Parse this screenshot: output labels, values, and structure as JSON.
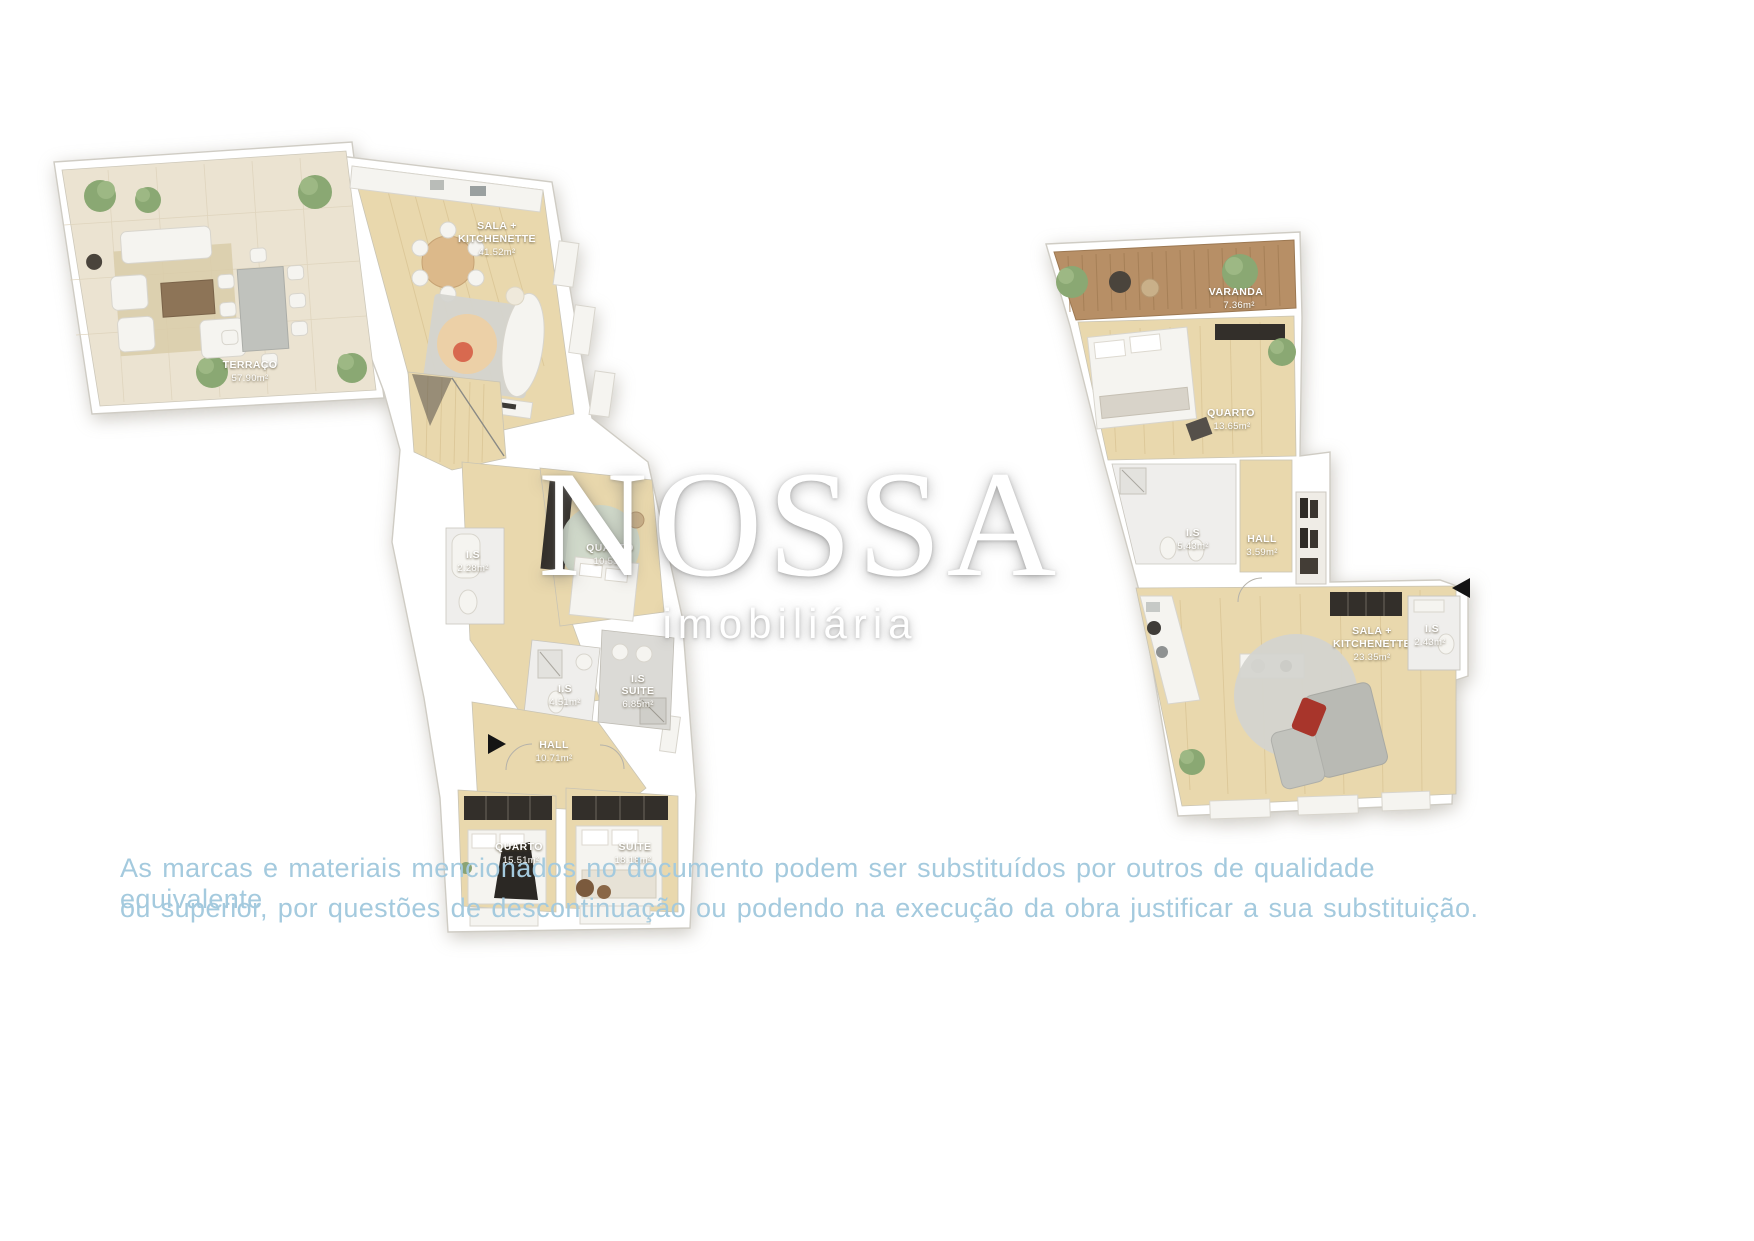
{
  "watermark": {
    "brand": "NOSSA",
    "tagline": "imobiliária"
  },
  "disclaimer": {
    "lines": [
      "As marcas e materiais mencionados no documento podem ser substituídos por outros de qualidade equivalente",
      "ou superior, por questões de descontinuação ou podendo na execução da obra justificar a sua substituição."
    ],
    "text_color": "#a4cade"
  },
  "plans": [
    {
      "name": "floor-plan-left",
      "rooms": [
        {
          "label_lines": [
            "TERRAÇO"
          ],
          "area": "57.90m²"
        },
        {
          "label_lines": [
            "SALA +",
            "KITCHENETTE"
          ],
          "area": "41.52m²"
        },
        {
          "label_lines": [
            "I.S"
          ],
          "area": "2.28m²"
        },
        {
          "label_lines": [
            "QUARTO"
          ],
          "area": "10.51m²"
        },
        {
          "label_lines": [
            "I.S"
          ],
          "area": "4.51m²"
        },
        {
          "label_lines": [
            "I.S",
            "SUITE"
          ],
          "area": "6.85m²"
        },
        {
          "label_lines": [
            "HALL"
          ],
          "area": "10.71m²"
        },
        {
          "label_lines": [
            "QUARTO"
          ],
          "area": "15.51m²"
        },
        {
          "label_lines": [
            "SUITE"
          ],
          "area": "18.18m²"
        }
      ]
    },
    {
      "name": "floor-plan-right",
      "rooms": [
        {
          "label_lines": [
            "VARANDA"
          ],
          "area": "7.36m²"
        },
        {
          "label_lines": [
            "QUARTO"
          ],
          "area": "13.65m²"
        },
        {
          "label_lines": [
            "I.S"
          ],
          "area": "5.43m²"
        },
        {
          "label_lines": [
            "HALL"
          ],
          "area": "3.59m²"
        },
        {
          "label_lines": [
            "SALA +",
            "KITCHENETTE"
          ],
          "area": "23.35m²"
        },
        {
          "label_lines": [
            "I.S"
          ],
          "area": "2.43m²"
        }
      ]
    }
  ],
  "icons": {
    "left_plan_entrance": "right-filled-triangle",
    "right_plan_entrance": "left-filled-triangle"
  },
  "colors": {
    "wood_floor": "#e9d8ad",
    "terrace_tile": "#ebe3d1",
    "deck_wood": "#b78f66",
    "bath_marble": "#efeeec",
    "label_text": "#ffffff"
  }
}
